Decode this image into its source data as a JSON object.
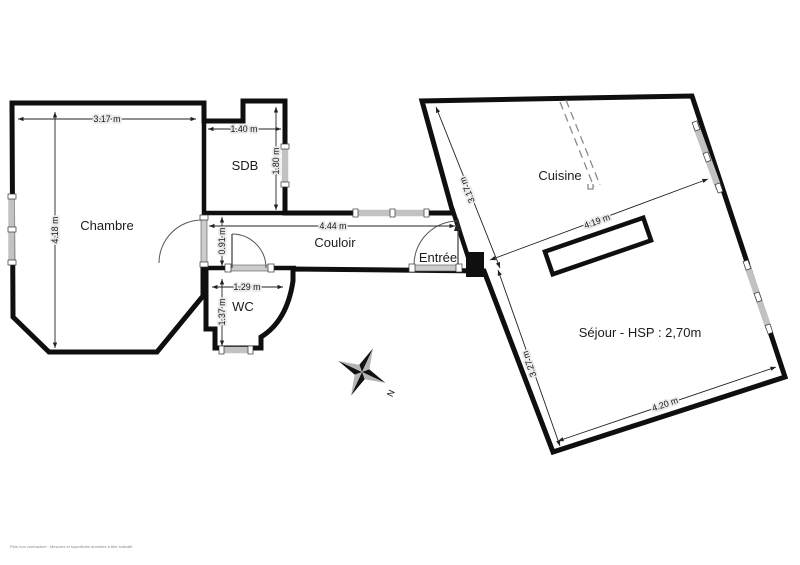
{
  "plan": {
    "type": "apartment-floor-plan",
    "rooms": [
      {
        "id": "chambre",
        "name": "Chambre"
      },
      {
        "id": "sdb",
        "name": "SDB"
      },
      {
        "id": "couloir",
        "name": "Couloir"
      },
      {
        "id": "wc",
        "name": "WC"
      },
      {
        "id": "entree",
        "name": "Entrée"
      },
      {
        "id": "cuisine",
        "name": "Cuisine"
      },
      {
        "id": "sejour",
        "name": "Séjour - HSP : 2,70m"
      }
    ],
    "dimensions": [
      {
        "room": "chambre",
        "label": "3.17 m"
      },
      {
        "room": "chambre",
        "label": "4.18 m"
      },
      {
        "room": "sdb",
        "label": "1.40 m"
      },
      {
        "room": "sdb",
        "label": "1.80 m"
      },
      {
        "room": "couloir",
        "label": "4.44 m"
      },
      {
        "room": "couloir",
        "label": "0.91 m"
      },
      {
        "room": "wc",
        "label": "1.29 m"
      },
      {
        "room": "wc",
        "label": "1.37 m"
      },
      {
        "room": "cuisine",
        "label": "3.17 m"
      },
      {
        "room": "cuisine",
        "label": "4.19 m"
      },
      {
        "room": "sejour",
        "label": "3.27 m"
      },
      {
        "room": "sejour",
        "label": "4.20 m"
      }
    ],
    "compass": {
      "north_label": "N"
    },
    "watermark": "Plan non contractuel - Mesures et superficies données à titre indicatif",
    "colors": {
      "floor": "#e9e9e9",
      "wall": "#0f0f0f",
      "window": "#c2c2c2",
      "door": "#cccccc",
      "dimension": "#222222",
      "label": "#1c1c1c"
    }
  }
}
